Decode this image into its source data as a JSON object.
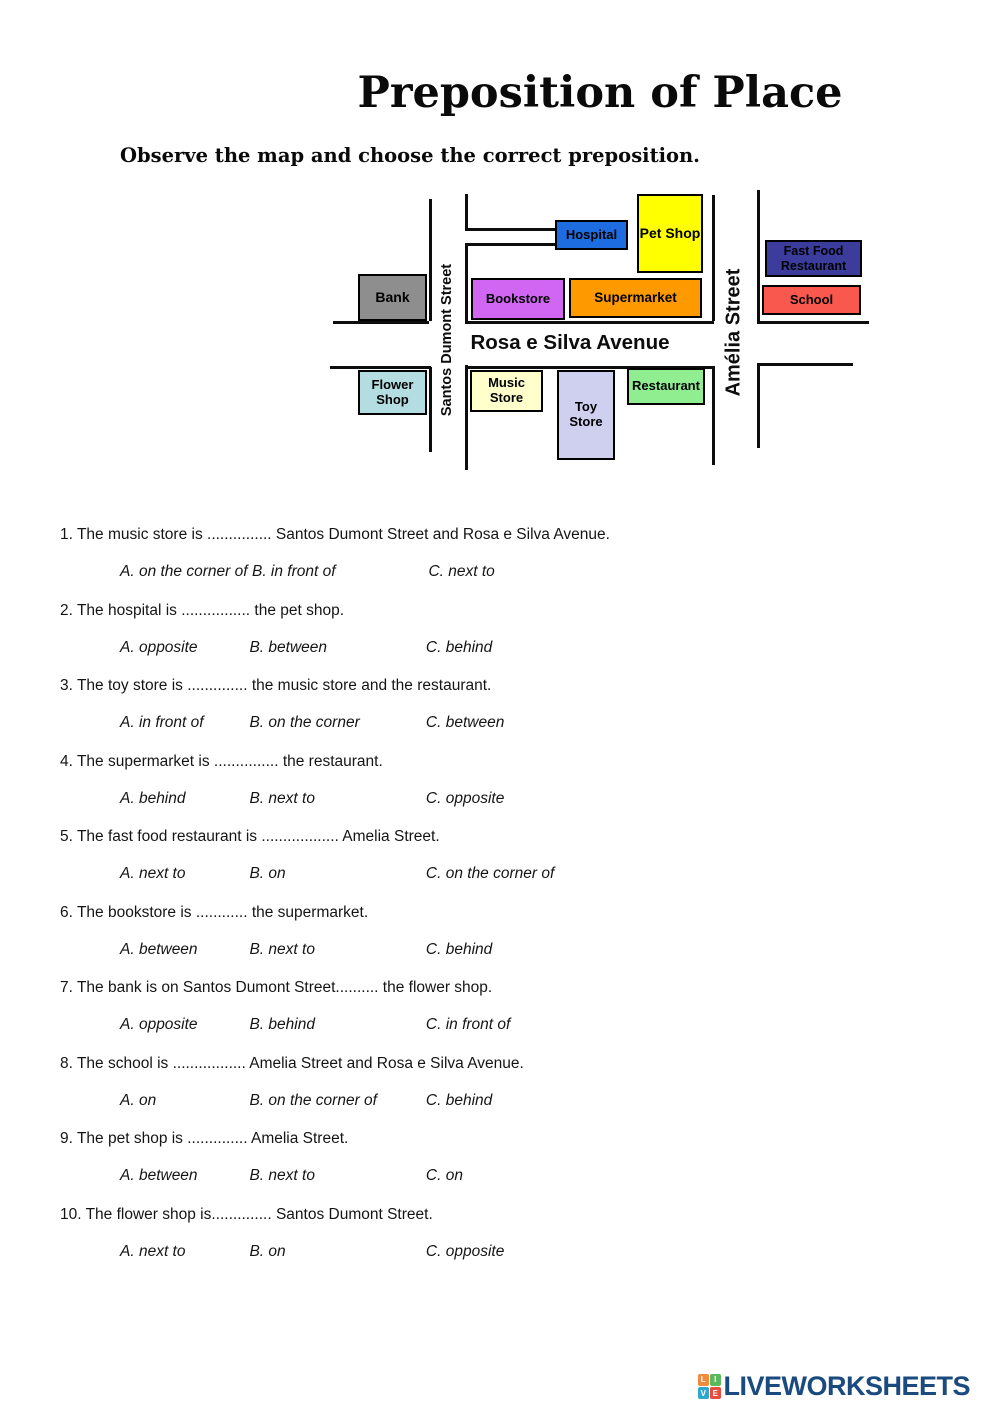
{
  "title": "Preposition of Place",
  "instruction": "Observe the map and choose the correct preposition.",
  "map": {
    "streets": {
      "santos": "Santos Dumont Street",
      "amelia": "Amélia Street",
      "avenue": "Rosa e Silva Avenue"
    },
    "buildings": {
      "bank": {
        "label": "Bank",
        "color": "#8e8e8e"
      },
      "hospital": {
        "label": "Hospital",
        "color": "#1e6de0"
      },
      "pet_shop": {
        "label": "Pet Shop",
        "color": "#ffff00"
      },
      "bookstore": {
        "label": "Bookstore",
        "color": "#d066f2"
      },
      "supermarket": {
        "label": "Supermarket",
        "color": "#ff9900"
      },
      "fast_food": {
        "label": "Fast Food Restaurant",
        "color": "#3c3c9c"
      },
      "school": {
        "label": "School",
        "color": "#f8584e"
      },
      "flower_shop": {
        "label": "Flower Shop",
        "color": "#b4dde2"
      },
      "music_store": {
        "label": "Music Store",
        "color": "#ffffcc"
      },
      "toy_store": {
        "label": "Toy Store",
        "color": "#cfcfef"
      },
      "restaurant": {
        "label": "Restaurant",
        "color": "#90ee90"
      }
    }
  },
  "questions": [
    {
      "text": "1. The music store is ............... Santos Dumont Street and Rosa e Silva Avenue.",
      "options": [
        "A. on the corner of",
        "B. in front of",
        "C. next to"
      ]
    },
    {
      "text": "2. The hospital is ................ the pet shop.",
      "options": [
        "A. opposite",
        "B. between",
        "C. behind"
      ]
    },
    {
      "text": "3. The toy store is .............. the music store and the restaurant.",
      "options": [
        "A.  in front of",
        "B. on the corner",
        "C.  between"
      ]
    },
    {
      "text": "4. The supermarket is ............... the restaurant.",
      "options": [
        "A.  behind",
        "B. next to",
        "C.  opposite"
      ]
    },
    {
      "text": "5. The fast food restaurant is .................. Amelia Street.",
      "options": [
        "A. next to",
        "B. on",
        "C. on the corner of"
      ]
    },
    {
      "text": "6. The bookstore is ............ the supermarket.",
      "options": [
        "A. between",
        "B.  next to",
        "C. behind"
      ]
    },
    {
      "text": "7. The bank is on Santos Dumont Street.......... the flower shop.",
      "options": [
        "A. opposite",
        "B. behind",
        "C. in front of"
      ]
    },
    {
      "text": "8. The school is ................. Amelia Street and  Rosa e Silva Avenue.",
      "options": [
        "A. on",
        "B. on the corner of",
        "C.  behind"
      ]
    },
    {
      "text": "9. The pet shop is .............. Amelia Street.",
      "options": [
        "A. between",
        "B. next to",
        "C. on"
      ]
    },
    {
      "text": "10. The flower shop is.............. Santos Dumont Street.",
      "options": [
        "A. next to",
        "B. on",
        "C. opposite"
      ]
    }
  ],
  "footer": {
    "brand": "LIVEWORKSHEETS",
    "tiles": [
      "L",
      "I",
      "V",
      "E"
    ],
    "tile_colors": [
      "#f08a3c",
      "#5cb85c",
      "#31a8c9",
      "#e74c3c"
    ],
    "brand_color": "#1b4a7e"
  }
}
